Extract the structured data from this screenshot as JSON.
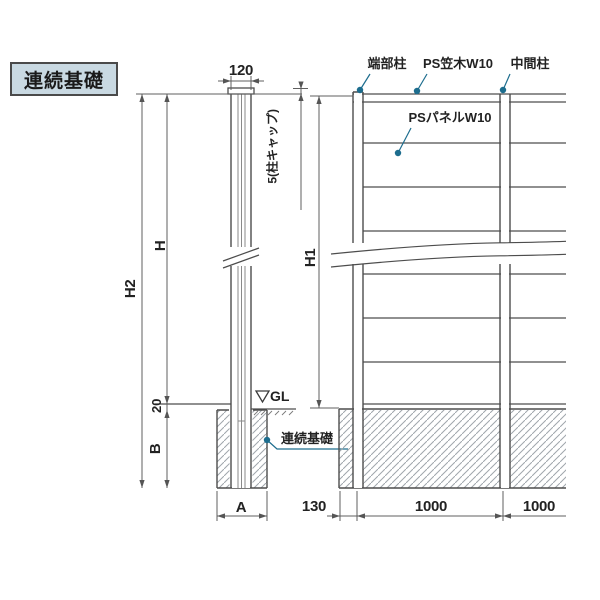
{
  "drawing": {
    "title": "連続基礎",
    "side_view": {
      "dim_width": "120",
      "cap_note": "5(柱キャップ)",
      "dim_h": "H",
      "dim_h2": "H2",
      "dim_20": "20",
      "dim_b": "B",
      "dim_a": "A",
      "gl_label": "GL",
      "foundation_label": "連続基礎"
    },
    "elevation_view": {
      "end_post_label": "端部柱",
      "cap_rail_label": "PS笠木W10",
      "mid_post_label": "中間柱",
      "panel_label": "PSパネルW10",
      "dim_h1": "H1",
      "dim_130": "130",
      "dim_1000_left": "1000",
      "dim_1000_right": "1000"
    },
    "colors": {
      "accent": "#1d6d8e",
      "title_bg": "#c9d9e2",
      "line": "#4d4d4d"
    }
  }
}
